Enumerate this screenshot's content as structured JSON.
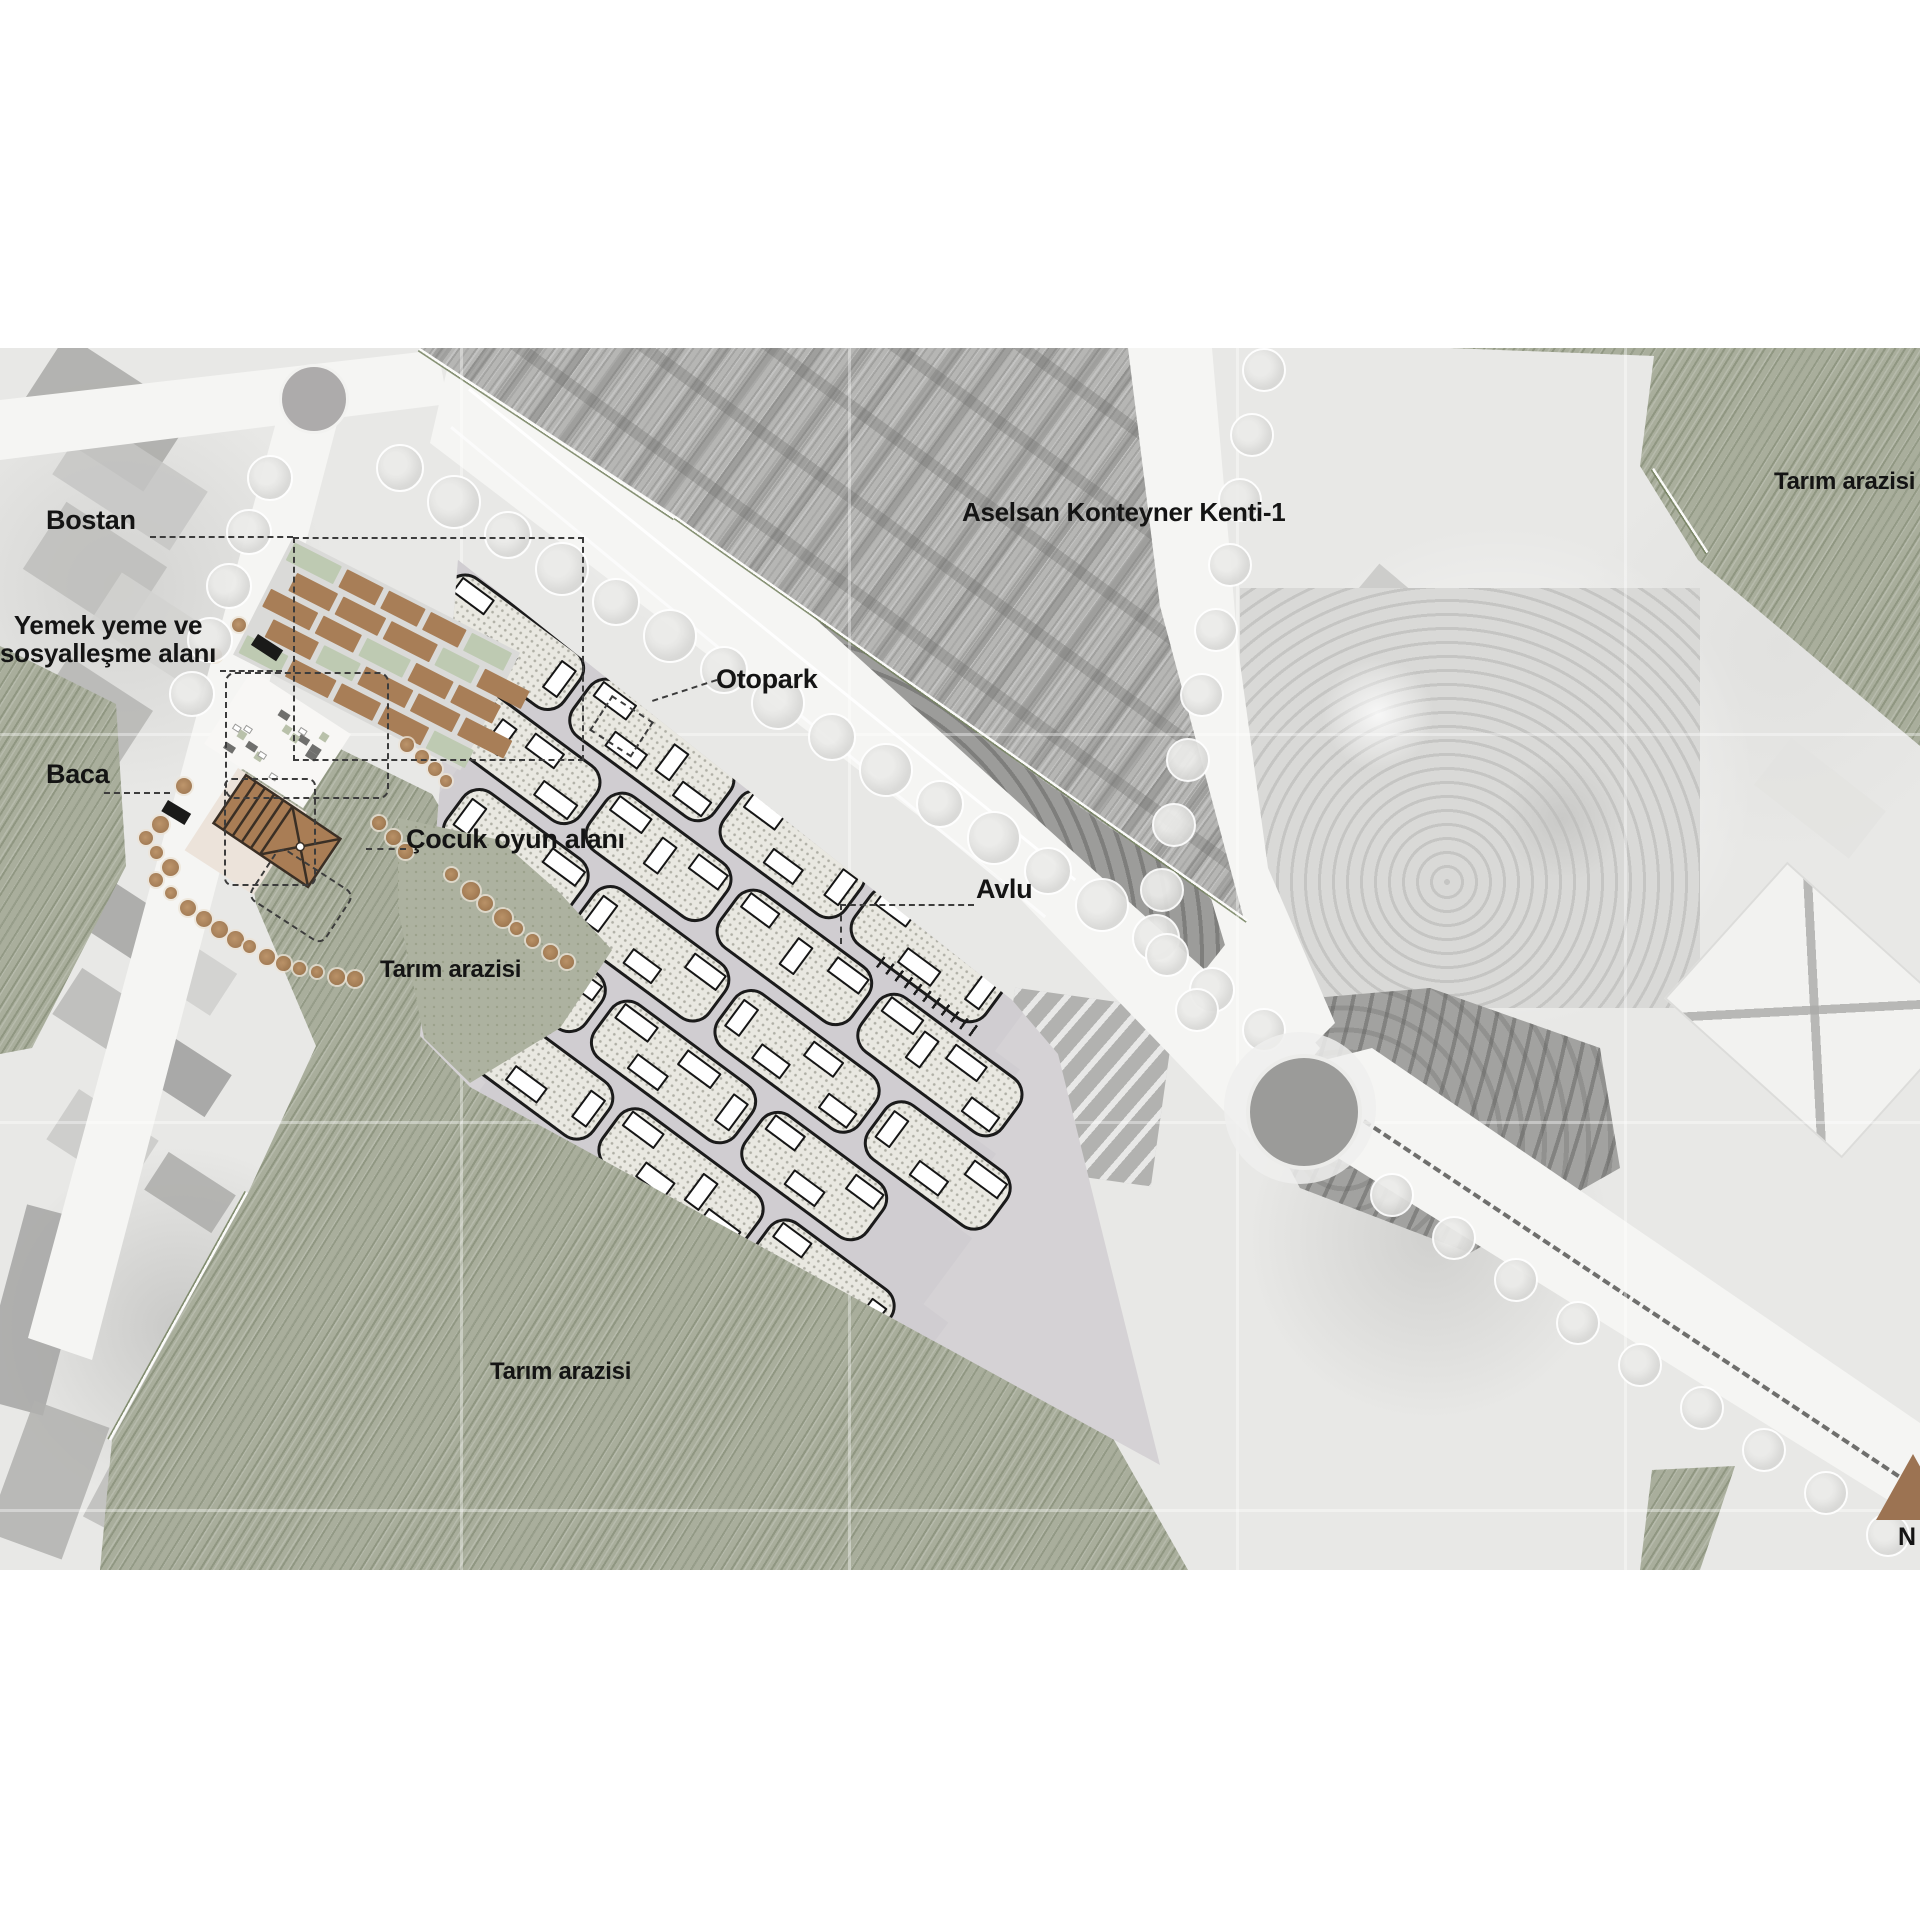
{
  "annotations": {
    "bostan": {
      "label": "Bostan"
    },
    "yemek": {
      "label": "Yemek yeme ve\nsosyalleşme alanı"
    },
    "baca": {
      "label": "Baca"
    },
    "cocuk_oyun": {
      "label": "Çocuk oyun alanı"
    },
    "otopark": {
      "label": "Otopark"
    },
    "avlu": {
      "label": "Avlu"
    },
    "aselsan": {
      "label": "Aselsan Konteyner Kenti-1"
    },
    "tarim_arazisi": {
      "label": "Tarım arazisi"
    },
    "north": {
      "label": "N"
    }
  },
  "colors": {
    "agriculture_green": "#a9ae9c",
    "bostan_plot_brown": "#a87e57",
    "building_roof_brown": "#a97d55",
    "container_city_gray": "#b6b6b4",
    "north_arrow_brown": "#9c7352",
    "cluster_outline": "#1b1b1b",
    "label_text": "#141414"
  }
}
